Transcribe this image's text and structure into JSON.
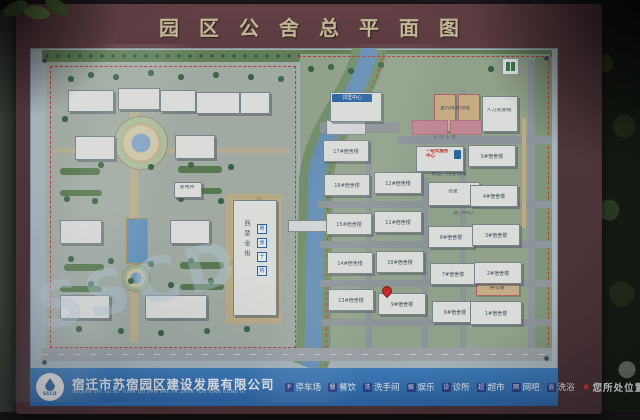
{
  "board": {
    "title": "园区公舍总平面图"
  },
  "map": {
    "central_building": {
      "name": "西楚金街"
    },
    "service_icons": [
      {
        "name": "restroom-icon",
        "glyph": "男"
      },
      {
        "name": "dining-icon",
        "glyph": "食"
      },
      {
        "name": "clinic-icon",
        "glyph": "十"
      },
      {
        "name": "supermarket-icon",
        "glyph": "购"
      }
    ],
    "dorm_buildings": [
      {
        "label": "17#宿舍楼",
        "style": {
          "left": "293px",
          "top": "92px",
          "width": "44px",
          "height": "20px"
        }
      },
      {
        "label": "16#宿舍楼",
        "style": {
          "left": "294px",
          "top": "126px",
          "width": "44px",
          "height": "20px"
        }
      },
      {
        "label": "15#宿舍楼",
        "style": {
          "left": "296px",
          "top": "165px",
          "width": "44px",
          "height": "20px"
        }
      },
      {
        "label": "14#宿舍楼",
        "style": {
          "left": "297px",
          "top": "204px",
          "width": "44px",
          "height": "20px"
        }
      },
      {
        "label": "13#宿舍楼",
        "style": {
          "left": "298px",
          "top": "241px",
          "width": "44px",
          "height": "20px"
        }
      },
      {
        "label": "12#宿舍楼",
        "style": {
          "left": "344px",
          "top": "124px",
          "width": "46px",
          "height": "20px"
        }
      },
      {
        "label": "11#宿舍楼",
        "style": {
          "left": "344px",
          "top": "163px",
          "width": "46px",
          "height": "20px"
        }
      },
      {
        "label": "10#宿舍楼",
        "style": {
          "left": "346px",
          "top": "203px",
          "width": "46px",
          "height": "20px"
        }
      },
      {
        "label": "9#宿舍楼",
        "style": {
          "left": "348px",
          "top": "245px",
          "width": "46px",
          "height": "20px"
        }
      },
      {
        "label": "8#宿舍楼",
        "style": {
          "left": "398px",
          "top": "178px",
          "width": "44px",
          "height": "20px"
        }
      },
      {
        "label": "7#宿舍楼",
        "style": {
          "left": "400px",
          "top": "215px",
          "width": "44px",
          "height": "20px"
        }
      },
      {
        "label": "6#宿舍楼",
        "style": {
          "left": "402px",
          "top": "253px",
          "width": "44px",
          "height": "20px"
        }
      },
      {
        "label": "5#宿舍楼",
        "style": {
          "left": "438px",
          "top": "97px",
          "width": "46px",
          "height": "20px"
        }
      },
      {
        "label": "4#宿舍楼",
        "style": {
          "left": "440px",
          "top": "137px",
          "width": "46px",
          "height": "20px"
        }
      },
      {
        "label": "3#宿舍楼",
        "style": {
          "left": "442px",
          "top": "176px",
          "width": "46px",
          "height": "20px"
        }
      },
      {
        "label": "2#宿舍楼",
        "style": {
          "left": "444px",
          "top": "214px",
          "width": "46px",
          "height": "20px"
        }
      },
      {
        "label": "1#宿舍楼",
        "style": {
          "left": "440px",
          "top": "253px",
          "width": "50px",
          "height": "22px"
        }
      }
    ],
    "labels": [
      {
        "name": "neighborhood-center-sign",
        "text": "邻里中心",
        "cls": "blue-sign",
        "style": {
          "left": "302px",
          "top": "46px",
          "width": "40px",
          "height": "8px"
        }
      },
      {
        "name": "sports-hall-label",
        "text": "室内体育场馆",
        "cls": "mlabel",
        "style": {
          "left": "400px",
          "top": "58px",
          "width": "50px"
        }
      },
      {
        "name": "hr-building-label",
        "text": "人力资源楼",
        "cls": "mlabel",
        "style": {
          "left": "454px",
          "top": "60px",
          "width": "30px"
        }
      },
      {
        "name": "one-stop-center-label",
        "text": "一站式服务中心",
        "cls": "red-label",
        "style": {
          "left": "396px",
          "top": "101px",
          "width": "26px"
        }
      },
      {
        "name": "canteen-property-label",
        "text": "食堂、物业管理",
        "cls": "mlabel",
        "style": {
          "left": "390px",
          "top": "124px",
          "width": "58px"
        }
      },
      {
        "name": "bathhouse-label",
        "text": "浴室",
        "cls": "mlabel",
        "style": {
          "left": "398px",
          "top": "141px",
          "width": "50px"
        }
      },
      {
        "name": "vitality-center-label",
        "text": "活力中心",
        "cls": "mlabel",
        "style": {
          "left": "420px",
          "top": "163px",
          "width": "26px"
        }
      },
      {
        "name": "carport-label",
        "text": "停车棚",
        "cls": "mlabel",
        "style": {
          "left": "448px",
          "top": "238px",
          "width": "38px"
        }
      },
      {
        "name": "substation-label",
        "text": "变电所",
        "cls": "mlabel",
        "style": {
          "left": "144px",
          "top": "137px",
          "width": "26px"
        }
      },
      {
        "name": "road-label",
        "text": "机动车道",
        "cls": "tiny-road",
        "style": {
          "left": "398px",
          "top": "87px",
          "width": "34px"
        }
      }
    ],
    "watermark": "SSCD"
  },
  "footer": {
    "logo_text": "SSCD",
    "company_cn": "宿迁市苏宿园区建设发展有限公司",
    "company_pinyin": "SUQIAN SHI SU SU YUAN QU JIAN SHE FA ZHAN YOU XIAN GONG SI",
    "legend": [
      {
        "icon": "parking-icon",
        "glyph": "P",
        "label": "停车场"
      },
      {
        "icon": "dining-icon",
        "glyph": "餐",
        "label": "餐饮"
      },
      {
        "icon": "restroom-icon",
        "glyph": "洗",
        "label": "洗手间"
      },
      {
        "icon": "entertainment-icon",
        "glyph": "娱",
        "label": "娱乐"
      },
      {
        "icon": "clinic-icon",
        "glyph": "诊",
        "label": "诊所"
      },
      {
        "icon": "supermarket-icon",
        "glyph": "超",
        "label": "超市"
      },
      {
        "icon": "internet-cafe-icon",
        "glyph": "网",
        "label": "网吧"
      },
      {
        "icon": "bath-icon",
        "glyph": "浴",
        "label": "洗浴"
      },
      {
        "icon": "location-star-icon",
        "glyph": "★",
        "label": "您所处位置",
        "cls": "star"
      }
    ]
  }
}
